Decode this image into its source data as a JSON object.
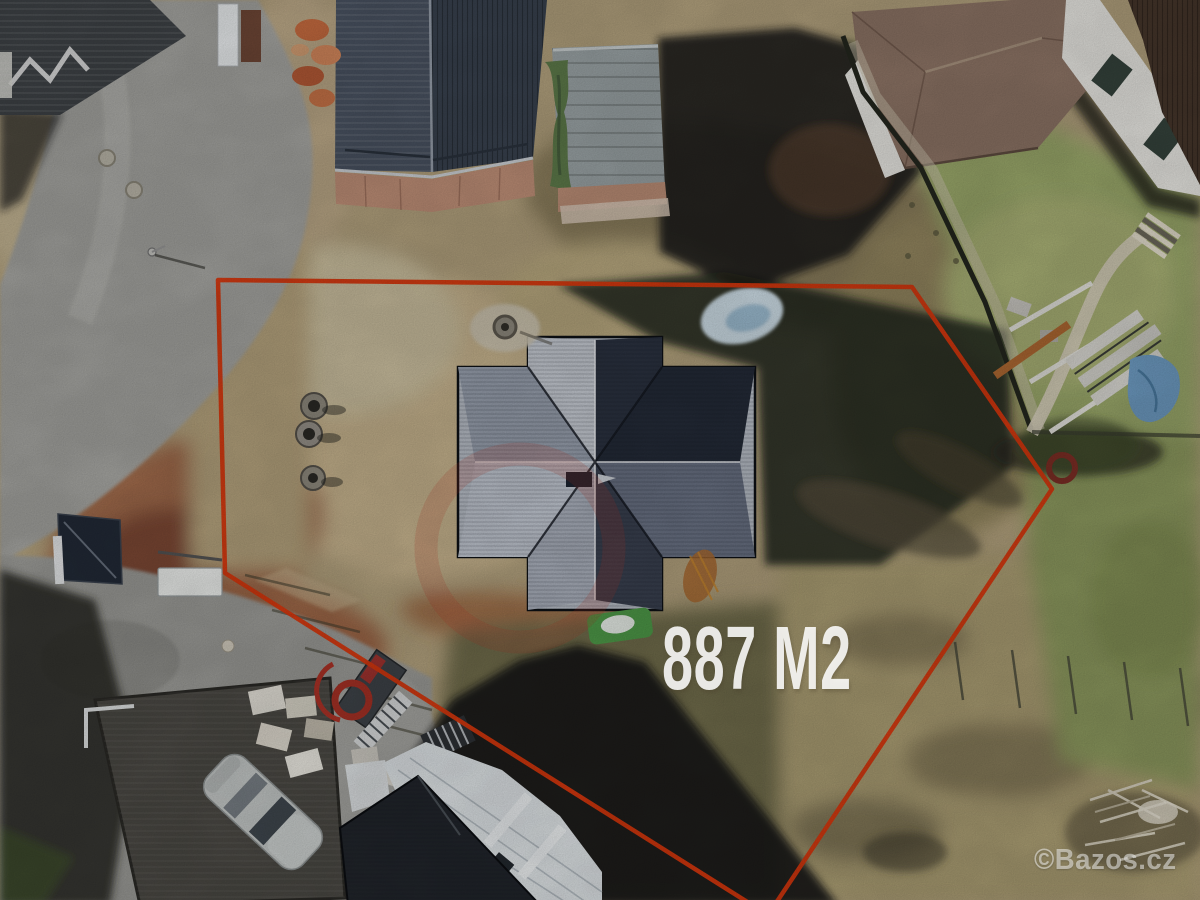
{
  "photo": {
    "area_label": "887 M2",
    "watermark_label": "©Bazos.cz",
    "boundary_color": "#d8380f",
    "boundary_points": "218,280 912,287 1052,489 768,915 225,573",
    "label_color": "#ffffff"
  }
}
